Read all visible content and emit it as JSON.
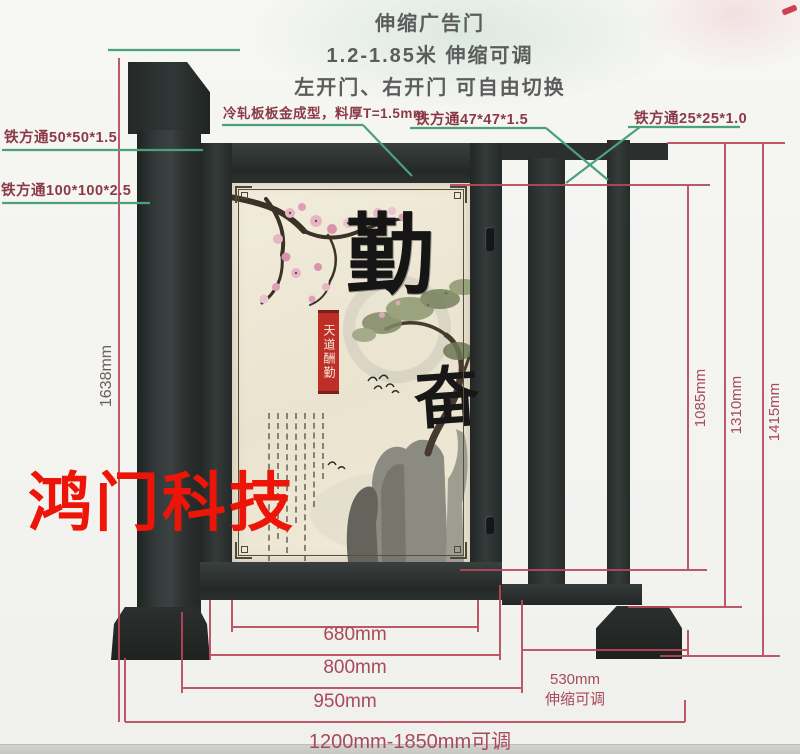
{
  "header": {
    "title": "伸缩广告门",
    "subtitle": "1.2-1.85米 伸缩可调",
    "subtitle2": "左开门、右开门 可自由切换"
  },
  "callouts": {
    "tube_50": "铁方通50*50*1.5",
    "tube_100": "铁方通100*100*2.5",
    "cold_rolled": "冷轧板板金成型，料厚T=1.5mm",
    "tube_47": "铁方通47*47*1.5",
    "tube_25": "铁方通25*25*1.0"
  },
  "dimensions": {
    "pillar_height": "1638mm",
    "opening_height": "1085mm",
    "frame_height": "1310mm",
    "overall_height": "1415mm",
    "panel_width": "680mm",
    "door_width": "800mm",
    "leaf_width": "950mm",
    "overall_width": "1200mm-1850mm可调",
    "telescopic_width": "530mm",
    "telescopic_note": "伸缩可调"
  },
  "poster": {
    "main_char": "勤",
    "second_char": "奋",
    "ribbon_text": "天道酬勤"
  },
  "watermark": "鸿门科技",
  "colors": {
    "dimension_red": "#b8485a",
    "callout_green": "#4aa17c",
    "callout_text": "#8a3b47",
    "gate_dark": "#2d3231",
    "poster_cream": "#efe9d7",
    "watermark_red": "#ec1507"
  }
}
